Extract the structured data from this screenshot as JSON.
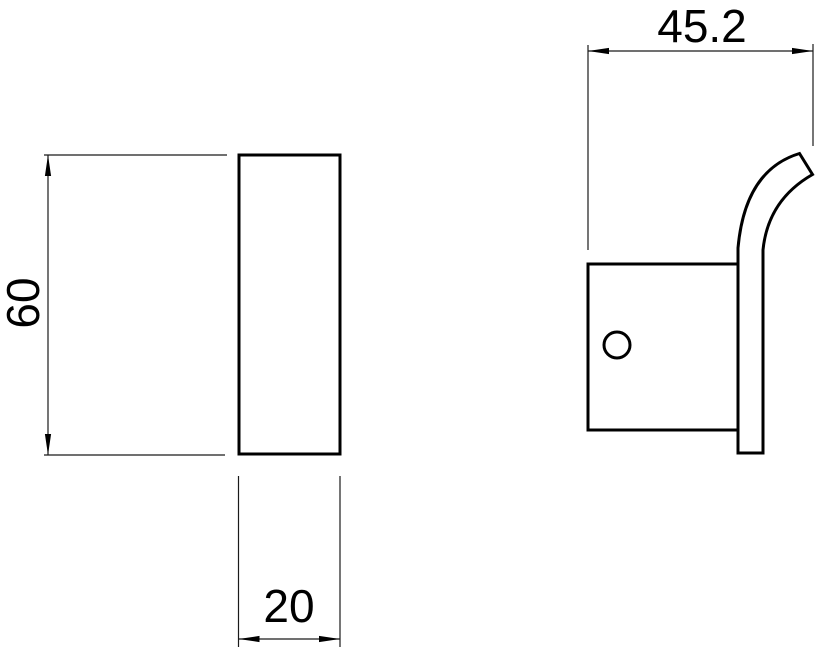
{
  "drawing": {
    "kind": "two-view technical drawing of a wall hook",
    "colors": {
      "background": "#ffffff",
      "object_line": "#000000",
      "dimension_line": "#1a1a1a",
      "text": "#000000"
    },
    "front_view": {
      "height_label": "60",
      "width_label": "20"
    },
    "side_view": {
      "depth_label": "45.2"
    }
  }
}
